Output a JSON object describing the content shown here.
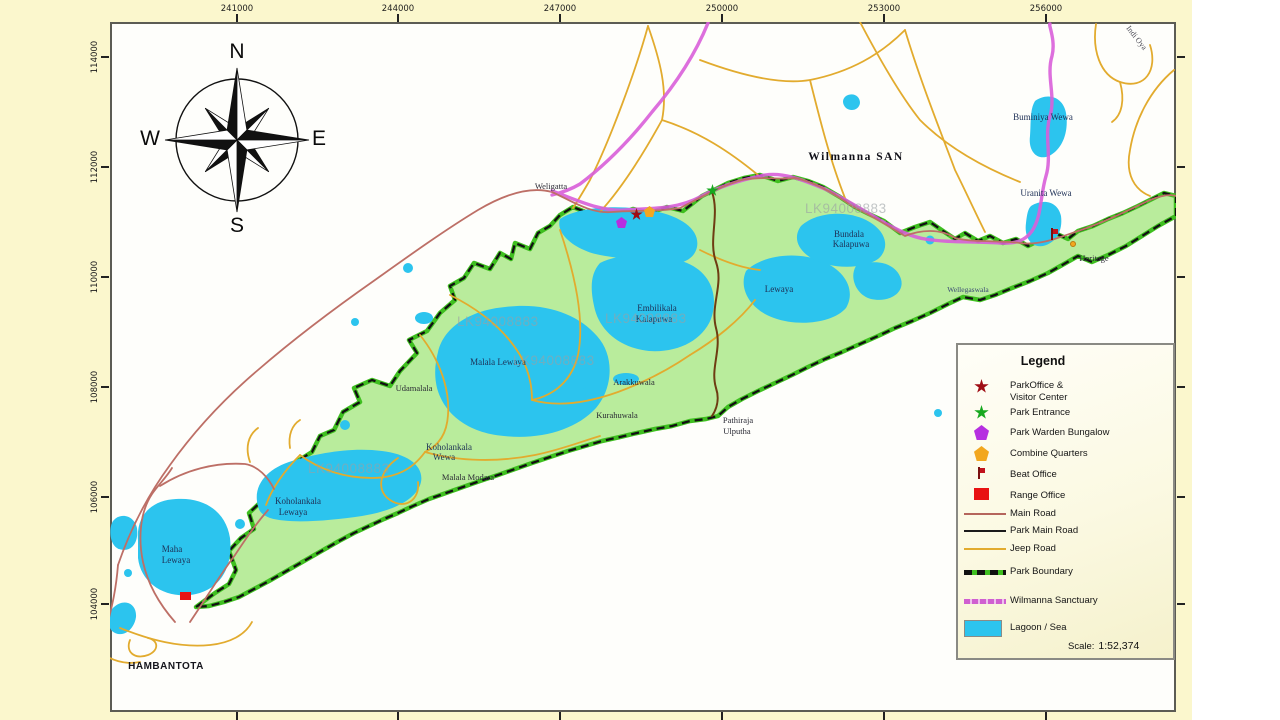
{
  "axes": {
    "top": {
      "labels": [
        "241000",
        "244000",
        "247000",
        "250000",
        "253000",
        "256000"
      ],
      "x": [
        237,
        398,
        560,
        722,
        884,
        1046
      ]
    },
    "left": {
      "labels": [
        "114000",
        "112000",
        "110000",
        "108000",
        "106000",
        "104000"
      ],
      "y": [
        57,
        167,
        277,
        387,
        497,
        604
      ]
    }
  },
  "compass": {
    "north": "N",
    "south": "S",
    "east": "E",
    "west": "W"
  },
  "legend": {
    "title": "Legend",
    "items": [
      {
        "symbol": "star-red",
        "label": "ParkOffice &\nVisitor Center"
      },
      {
        "symbol": "star-green",
        "label": "Park Entrance"
      },
      {
        "symbol": "pentagon-purple",
        "label": "Park Warden Bungalow"
      },
      {
        "symbol": "pentagon-orange",
        "label": "Combine Quarters"
      },
      {
        "symbol": "flag-red",
        "label": "Beat Office"
      },
      {
        "symbol": "square-red",
        "label": "Range Office"
      },
      {
        "symbol": "line-main",
        "label": "Main Road"
      },
      {
        "symbol": "line-park",
        "label": "Park Main Road"
      },
      {
        "symbol": "line-jeep",
        "label": "Jeep Road"
      },
      {
        "symbol": "line-boundary",
        "label": "Park Boundary"
      },
      {
        "symbol": "line-sanctuary",
        "label": "Wilmanna Sanctuary"
      },
      {
        "symbol": "swatch-lagoon",
        "label": "Lagoon / Sea"
      }
    ],
    "scale_label": "Scale:",
    "scale_value": "1:52,374"
  },
  "map": {
    "labels": [
      {
        "text": "Weligatta",
        "x": 551,
        "y": 182,
        "cls": "town"
      },
      {
        "text": "Wilmanna  SAN",
        "x": 856,
        "y": 151,
        "cls": "bold-title"
      },
      {
        "text": "Buminiya Wewa",
        "x": 1043,
        "y": 113,
        "cls": ""
      },
      {
        "text": "Uranita Wewa",
        "x": 1046,
        "y": 189,
        "cls": ""
      },
      {
        "text": "Bundala",
        "x": 849,
        "y": 230,
        "cls": ""
      },
      {
        "text": "Kalapuwa",
        "x": 851,
        "y": 240,
        "cls": ""
      },
      {
        "text": "Lewaya",
        "x": 779,
        "y": 285,
        "cls": ""
      },
      {
        "text": "Embilikala",
        "x": 657,
        "y": 304,
        "cls": ""
      },
      {
        "text": "Kalapuwa",
        "x": 654,
        "y": 315,
        "cls": ""
      },
      {
        "text": "Malala Lewaya",
        "x": 498,
        "y": 358,
        "cls": ""
      },
      {
        "text": "Udamalala",
        "x": 414,
        "y": 384,
        "cls": "town"
      },
      {
        "text": "Arakkuwala",
        "x": 634,
        "y": 378,
        "cls": "town"
      },
      {
        "text": "Kurahuwala",
        "x": 617,
        "y": 411,
        "cls": "town"
      },
      {
        "text": "Koholankala",
        "x": 449,
        "y": 443,
        "cls": ""
      },
      {
        "text": "Wewa",
        "x": 444,
        "y": 453,
        "cls": ""
      },
      {
        "text": "Malala Modara",
        "x": 468,
        "y": 473,
        "cls": "town"
      },
      {
        "text": "Koholankala",
        "x": 298,
        "y": 497,
        "cls": ""
      },
      {
        "text": "Lewaya",
        "x": 293,
        "y": 508,
        "cls": ""
      },
      {
        "text": "Maha",
        "x": 172,
        "y": 545,
        "cls": ""
      },
      {
        "text": "Lewaya",
        "x": 176,
        "y": 556,
        "cls": ""
      },
      {
        "text": "Pathiraja",
        "x": 738,
        "y": 416,
        "cls": "town"
      },
      {
        "text": "Ulputha",
        "x": 737,
        "y": 427,
        "cls": "town"
      },
      {
        "text": "Heritage",
        "x": 1094,
        "y": 254,
        "cls": "town"
      },
      {
        "text": "Wellegaswala",
        "x": 968,
        "y": 286,
        "cls": "small"
      },
      {
        "text": "HAMBANTOTA",
        "x": 166,
        "y": 662,
        "cls": "city"
      },
      {
        "text": "Indi Oya",
        "x": 1136,
        "y": 34,
        "cls": "rotated"
      }
    ],
    "watermark_text": "LK94008883",
    "watermarks": [
      {
        "x": 497,
        "y": 314
      },
      {
        "x": 553,
        "y": 353
      },
      {
        "x": 348,
        "y": 461
      },
      {
        "x": 845,
        "y": 201
      },
      {
        "x": 645,
        "y": 311
      }
    ],
    "markers": [
      {
        "type": "star-red",
        "x": 636,
        "y": 214,
        "name": "park-office-marker"
      },
      {
        "type": "star-green",
        "x": 712,
        "y": 190,
        "name": "park-entrance-marker"
      },
      {
        "type": "pentagon-purple",
        "x": 622,
        "y": 223,
        "name": "park-warden-bungalow-marker"
      },
      {
        "type": "pentagon-orange",
        "x": 650,
        "y": 212,
        "name": "combine-quarters-marker"
      },
      {
        "type": "square-red",
        "x": 186,
        "y": 598,
        "name": "range-office-marker"
      },
      {
        "type": "flag-red",
        "x": 1053,
        "y": 234,
        "name": "beat-office-marker"
      },
      {
        "type": "dot-orange",
        "x": 1076,
        "y": 247,
        "name": "poi-dot-marker"
      }
    ]
  },
  "colors": {
    "page_background": "#fbf7cd",
    "map_background": "#fefefb",
    "park_green": "#b9ec9c",
    "boundary_green": "#3fbf20",
    "boundary_dash": "#111111",
    "lagoon_blue": "#2cc4ee",
    "jeep_road": "#e2ab2e",
    "main_road": "#bd6f66",
    "park_main_road": "#6e3c12",
    "sanctuary_magenta": "#d95fd9",
    "marker_red": "#9f0d14",
    "marker_green": "#17a81f",
    "marker_purple": "#b62fe0",
    "marker_orange": "#f2a71f",
    "range_red": "#e81212"
  }
}
